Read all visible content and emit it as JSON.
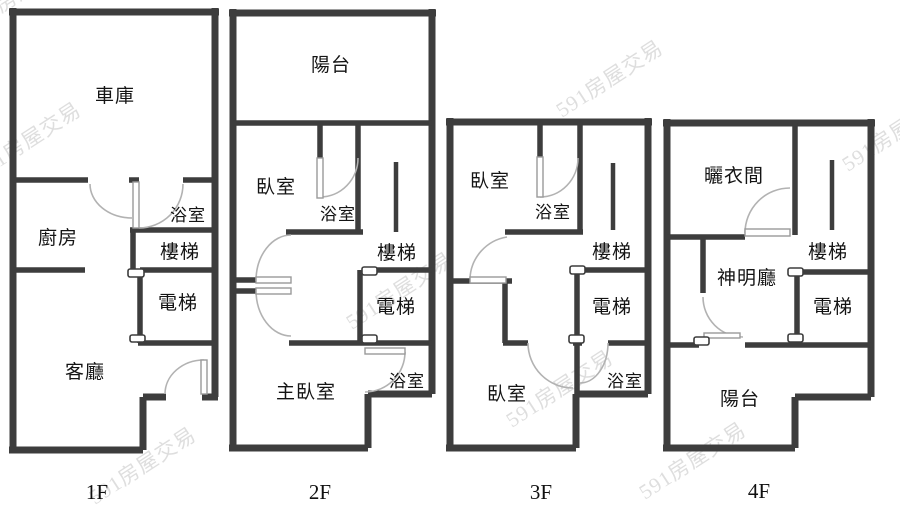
{
  "title": "4-floor townhouse floor plan",
  "watermark": {
    "text": "591房屋交易"
  },
  "colors": {
    "wall": "#3d3d3d",
    "arc": "#b2b2b2",
    "text": "#141414",
    "watermark": "#c9c9c9"
  },
  "floors": [
    {
      "label": "1F",
      "rooms": {
        "garage": "車庫",
        "kitchen": "廚房",
        "bath": "浴室",
        "stairs": "樓梯",
        "elevator": "電梯",
        "living": "客廳"
      }
    },
    {
      "label": "2F",
      "rooms": {
        "balcony": "陽台",
        "bedroom": "臥室",
        "bath_upper": "浴室",
        "stairs": "樓梯",
        "elevator": "電梯",
        "master": "主臥室",
        "bath_lower": "浴室"
      }
    },
    {
      "label": "3F",
      "rooms": {
        "bedroom_upper": "臥室",
        "bath_upper": "浴室",
        "stairs": "樓梯",
        "elevator": "電梯",
        "bedroom_lower": "臥室",
        "bath_lower": "浴室"
      }
    },
    {
      "label": "4F",
      "rooms": {
        "drying": "曬衣間",
        "shrine": "神明廳",
        "stairs": "樓梯",
        "elevator": "電梯",
        "balcony": "陽台"
      }
    }
  ]
}
